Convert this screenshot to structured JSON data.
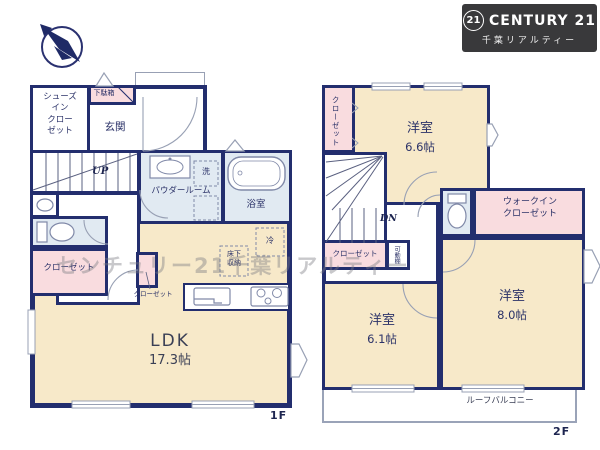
{
  "logo": {
    "badge": "21",
    "brand": "CENTURY 21",
    "subtitle": "千葉リアルティー"
  },
  "watermark": "センチュリー21千葉リアルティー",
  "colors": {
    "wall": "#232e6e",
    "room_cream": "#f7e9c9",
    "closet_pink": "#f9dcdf",
    "wet_blue": "#e1eaf2",
    "logo_bg": "#39393b"
  },
  "floor1": {
    "floor_label": "1F",
    "shoes_closet": "シューズ\nイン\nクロー\nゼット",
    "shoe_cabinet": "下駄箱",
    "entrance": "玄関",
    "stairs_up": "UP",
    "powder_room": "パウダールーム",
    "laundry": "洗",
    "bathroom": "浴室",
    "closet": "クローゼット",
    "hall_closet": "クローゼット",
    "underfloor_storage": "床下\n収納",
    "fridge": "冷",
    "ldk": "LDK",
    "ldk_size": "17.3帖"
  },
  "floor2": {
    "floor_label": "2F",
    "closet_top": "クローゼット",
    "bedroom_a": "洋室",
    "bedroom_a_size": "6.6帖",
    "stairs_down": "DN",
    "closet_mid": "クローゼット",
    "movable_shelf": "可動棚",
    "walk_in_closet": "ウォークイン\nクローゼット",
    "bedroom_b": "洋室",
    "bedroom_b_size": "6.1帖",
    "bedroom_c": "洋室",
    "bedroom_c_size": "8.0帖",
    "roof_balcony": "ルーフバルコニー"
  }
}
